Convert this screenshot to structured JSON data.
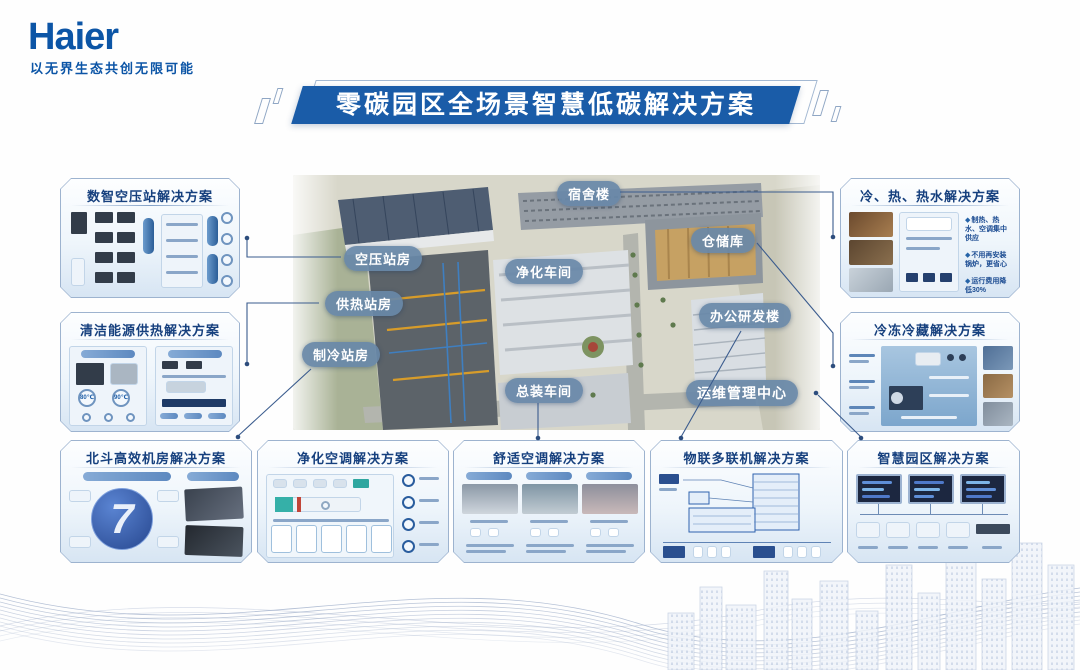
{
  "brand": {
    "logo": "Haier",
    "tagline": "以无界生态共创无限可能"
  },
  "title": "零碳园区全场景智慧低碳解决方案",
  "park": {
    "labels": {
      "air_compressor": "空压站房",
      "heating": "供热站房",
      "refrigeration": "制冷站房",
      "dormitory": "宿舍楼",
      "purification": "净化车间",
      "assembly": "总装车间",
      "warehouse": "仓储库",
      "office": "办公研发楼",
      "om_center": "运维管理中心"
    }
  },
  "cards": {
    "left": [
      {
        "title": "数智空压站解决方案"
      },
      {
        "title": "清洁能源供热解决方案",
        "temps": [
          "80℃",
          "90℃"
        ]
      }
    ],
    "right": [
      {
        "title": "冷、热、热水解决方案",
        "bullets": [
          "制热、热水、空调集中供应",
          "不用再安装锅炉，更省心",
          "运行费用降低30%"
        ]
      },
      {
        "title": "冷冻冷藏解决方案"
      }
    ],
    "bottom": [
      {
        "title": "北斗高效机房解决方案",
        "big_glyph": "7"
      },
      {
        "title": "净化空调解决方案"
      },
      {
        "title": "舒适空调解决方案"
      },
      {
        "title": "物联多联机解决方案"
      },
      {
        "title": "智慧园区解决方案"
      }
    ]
  },
  "colors": {
    "brand_blue": "#0c55a6",
    "title_bg": "#1a5ca8",
    "card_title": "#16407e",
    "park_label_bg": "#6888a8",
    "connector": "#3b5c8e"
  }
}
